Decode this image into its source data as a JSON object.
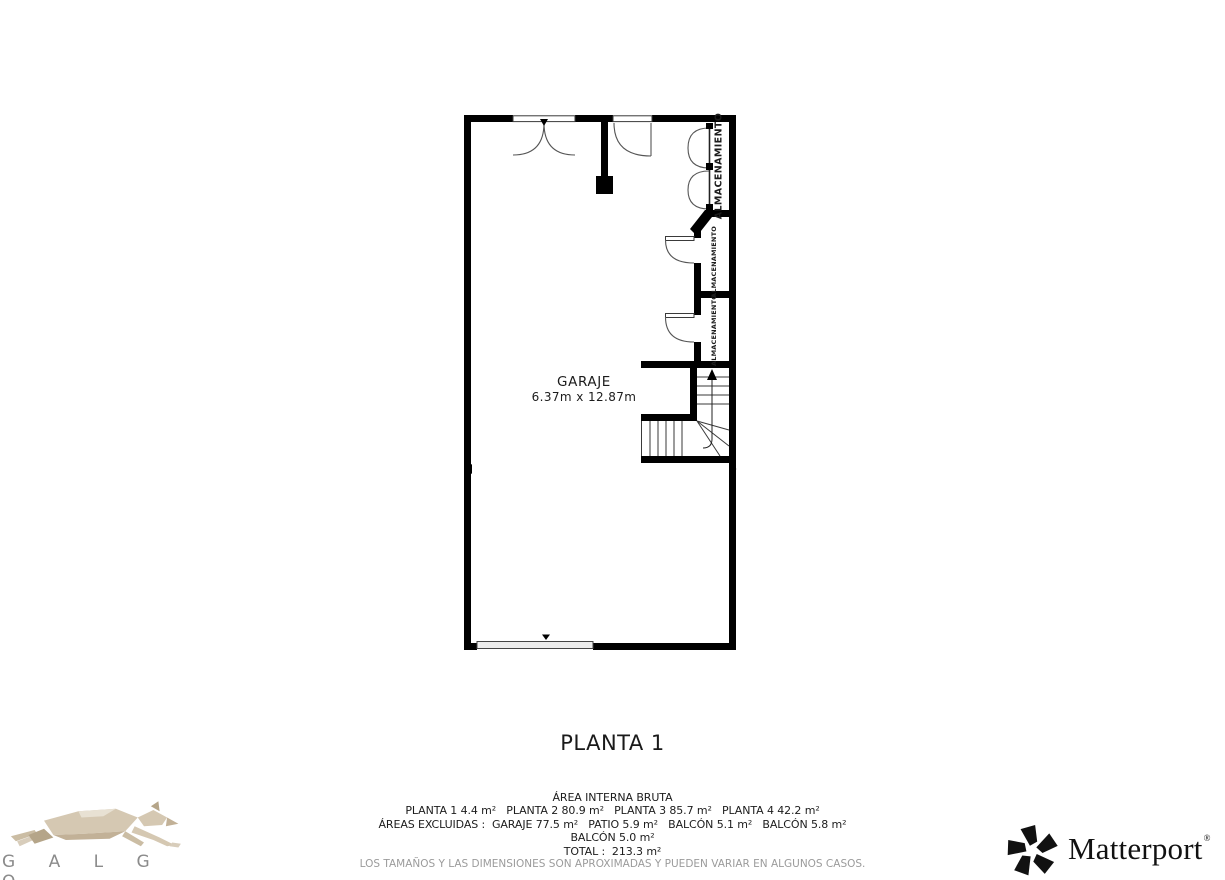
{
  "colors": {
    "wall": "#000000",
    "thin_line": "#3a3a3a",
    "arc_line": "#555555",
    "garage_door_fill": "#ececec",
    "text": "#1c1c1c",
    "muted_text": "#9b9b9b",
    "logo_tan": "#d5c8b2",
    "logo_tan_dark": "#b5a589",
    "logo_tan_light": "#e8e1d3",
    "logo_gray": "#8b8b8b",
    "matterport_black": "#111111"
  },
  "floor_plan": {
    "main_room": {
      "name": "GARAJE",
      "dimensions": "6.37m x 12.87m"
    },
    "storage_rooms": [
      {
        "label": "ALMACENAMIENTO"
      },
      {
        "label": "ALMACENAMIENTO"
      },
      {
        "label": "ALMACENAMIENTO"
      }
    ]
  },
  "floor_title": "PLANTA 1",
  "area_summary": {
    "heading": "ÁREA INTERNA BRUTA",
    "lines": [
      "PLANTA 1 4.4 m²   PLANTA 2 80.9 m²   PLANTA 3 85.7 m²   PLANTA 4 42.2 m²",
      "ÁREAS EXCLUIDAS :  GARAJE 77.5 m²   PATIO 5.9 m²   BALCÓN 5.1 m²   BALCÓN 5.8 m²",
      "BALCÓN 5.0 m²",
      "TOTAL :  213.3 m²"
    ],
    "disclaimer": "LOS TAMAÑOS Y LAS DIMENSIONES SON APROXIMADAS Y PUEDEN VARIAR EN ALGUNOS CASOS."
  },
  "branding": {
    "galgo": {
      "wordmark": "G A L G O"
    },
    "matterport": {
      "wordmark": "Matterport",
      "registered": "®"
    }
  }
}
